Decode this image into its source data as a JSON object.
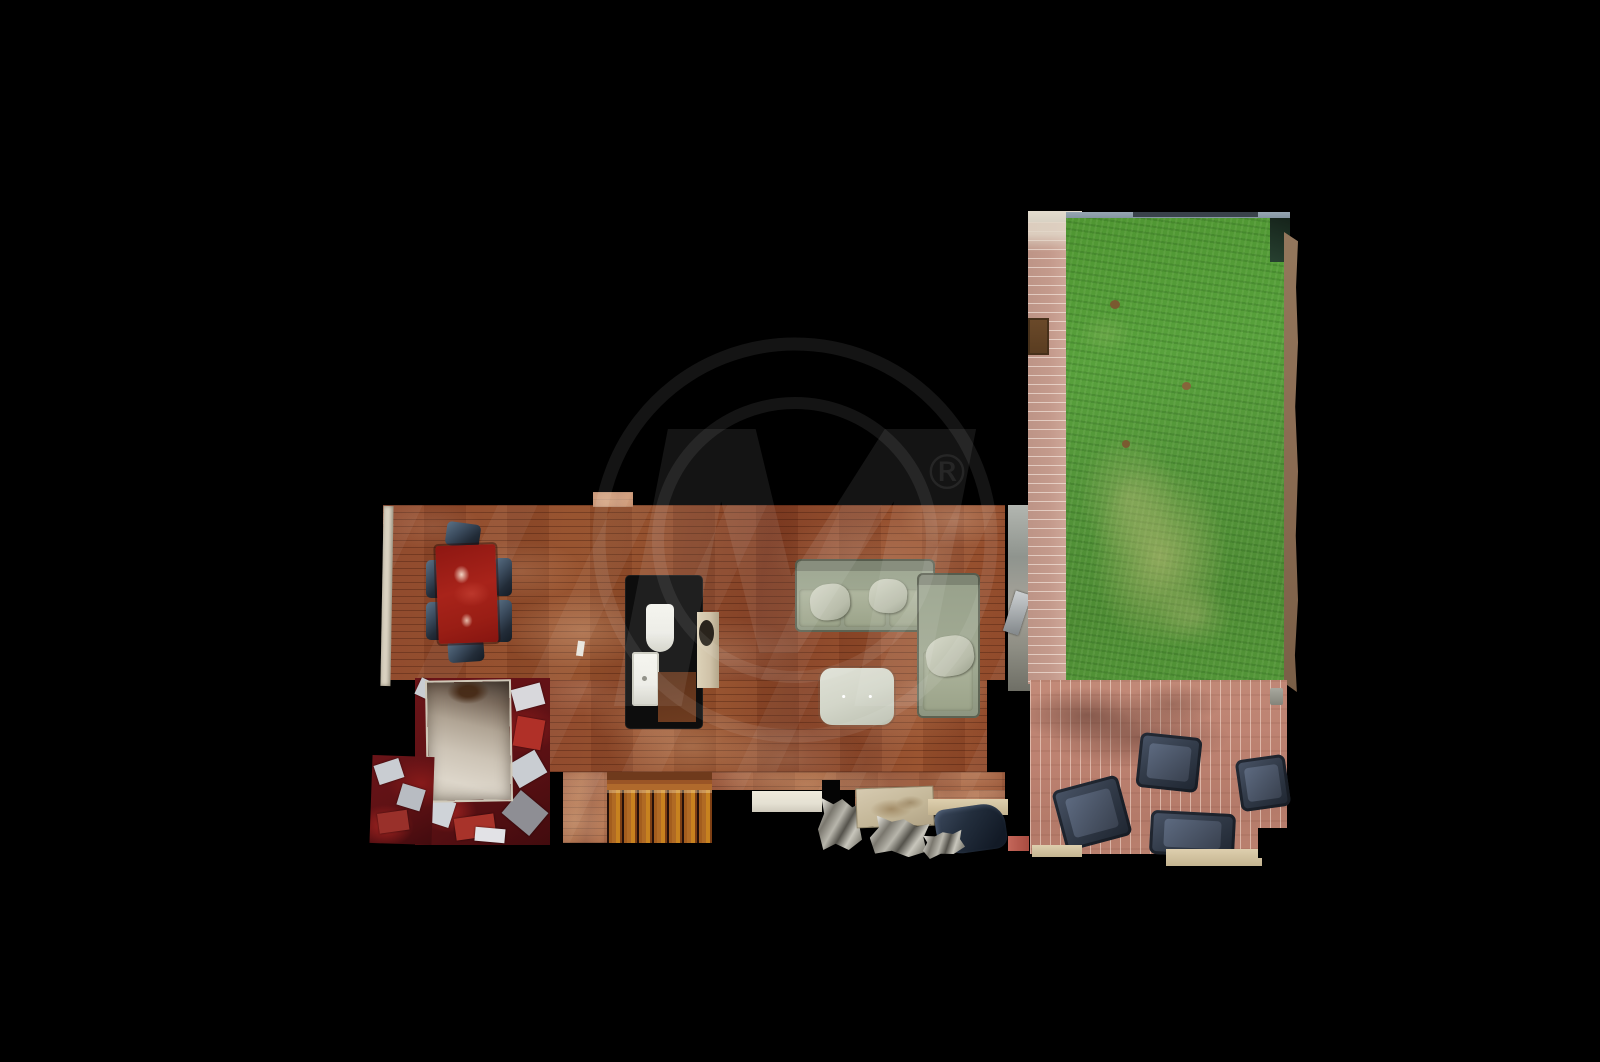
{
  "watermark": {
    "monogram": "M",
    "registered_symbol": "®",
    "color": "#ffffff",
    "opacity": 0.078
  },
  "palette": {
    "background": "#000000",
    "wood_floor": "#8a4428",
    "stair_tread": "#b06a24",
    "dining_table": "#a8231a",
    "dining_chair": "#222c38",
    "sofa": "#a2ab94",
    "ottoman": "#d3d6c9",
    "lawn": "#58a13c",
    "walkway_brick": "#c49a8c",
    "patio_brick": "#bd8271",
    "patio_chair": "#333c4a",
    "mirror_room_red": "#5e1114",
    "baseboard": "#d9d1c0",
    "powder_room_wall": "#0d0d0d",
    "fixture_white": "#ecece6",
    "door_panel": "#cfc2a8",
    "entry_mat": "#e4e0d2",
    "fence": "#8293a0",
    "dirt_edge": "#8a6b52"
  }
}
